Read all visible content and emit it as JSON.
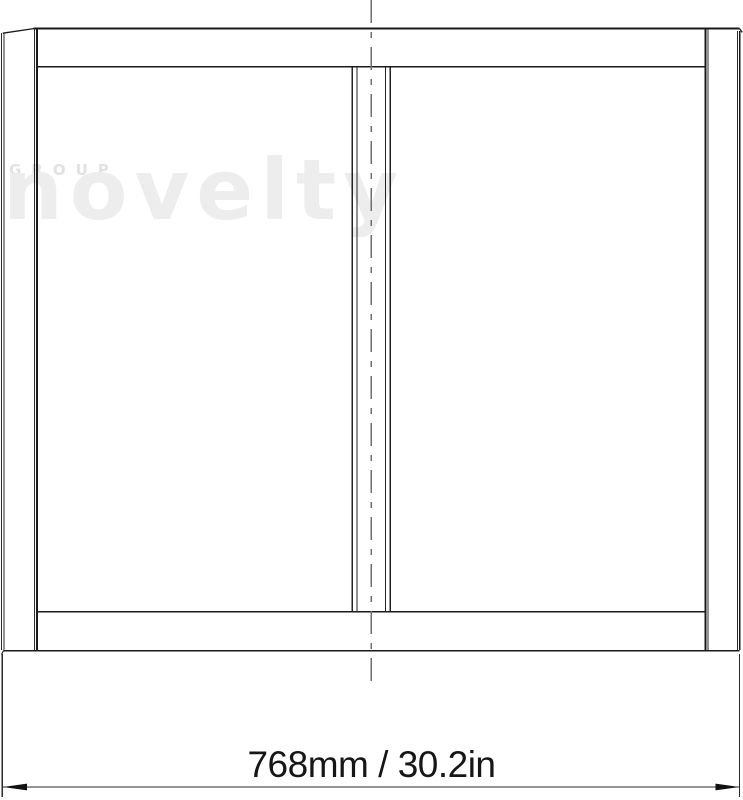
{
  "drawing": {
    "type": "technical-front-elevation",
    "subject": "rectangular panel with two bays and center divider"
  },
  "watermark": {
    "group_text": "GROUP",
    "brand_text": "novelty"
  },
  "dimension": {
    "label": "768mm / 30.2in"
  },
  "colors": {
    "background": "#ffffff",
    "line_heavy": "#1a1a1a",
    "line_light": "#303030",
    "centerline": "#6f6f6f",
    "dimension_line": "#2b2b2b",
    "dimension_text": "#161616",
    "watermark_brand": "#ededed",
    "watermark_group": "#e2e2e2"
  }
}
